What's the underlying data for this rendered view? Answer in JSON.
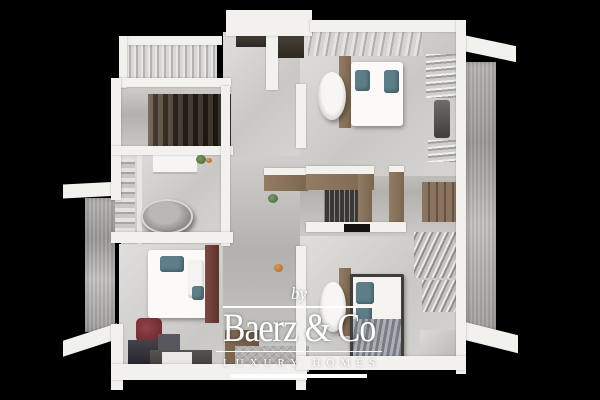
{
  "watermark": {
    "prefix": "by",
    "brand": "Baerz & Co",
    "tagline": "LUXURY HOMES",
    "color": "#ffffff"
  },
  "scene": {
    "kind": "3D rendered top-down floor plan of an apartment upper floor on a black background",
    "background": "#000000",
    "elements": [
      "stairwell",
      "curtained-window-bay",
      "bathroom-with-freestanding-tub",
      "vanity",
      "walk-in-closet-wardrobes",
      "hanging-clothes",
      "three-double-beds",
      "two-bedside-bathtubs",
      "balcony-ledges",
      "rug",
      "bench",
      "luggage",
      "red-chair"
    ],
    "palette": {
      "wall": "#f2f1ee",
      "floor": "#d6d5d2",
      "floor_shadow": "#b2b1ae",
      "wood": "#8a7360",
      "wood_dark": "#66513b",
      "stairs": "#32281f",
      "accent_teal": "#5d7e89",
      "headboard_red": "#6d4038",
      "concrete": "#a9a8a5",
      "accent_orange": "#c2803e",
      "accent_red": "#7c3034",
      "plant_green": "#5e7a4e"
    }
  }
}
